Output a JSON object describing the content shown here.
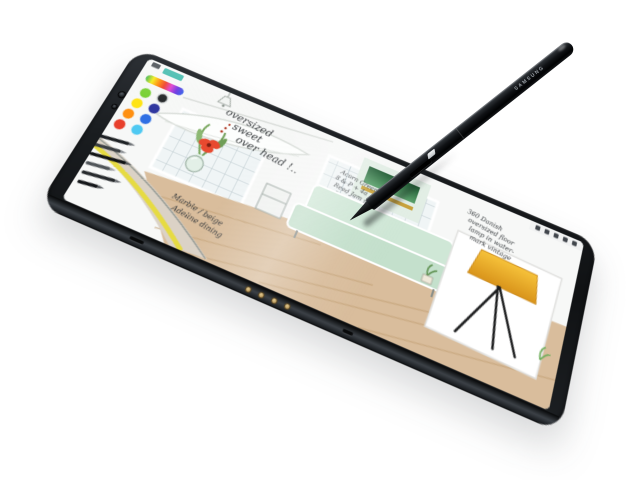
{
  "scene": {
    "description": "Product photo: Samsung tablet lying at an angle with S Pen stylus tip resting on screen; screen shows a sketching app with an interior-design drawing",
    "background_color": "#ffffff"
  },
  "tablet": {
    "body_color": "#17191c",
    "pogo_pin_count": 4,
    "camera_dot_count": 2
  },
  "stylus": {
    "label": "SAMSUNG",
    "body_color": "#101214"
  },
  "screen": {
    "mini_toolbar_icon_count": 5,
    "palette": {
      "preset_swatch": "#3cb9ab",
      "spectrum": [
        "#35b44a",
        "#f7ec13",
        "#ff8a00",
        "#ef3b25",
        "#e03bd0",
        "#6a30e0",
        "#2b59e8"
      ],
      "swatches": [
        {
          "name": "green",
          "hex": "#76d02f"
        },
        {
          "name": "black",
          "hex": "#202325"
        },
        {
          "name": "yellow",
          "hex": "#ffe414"
        },
        {
          "name": "navy",
          "hex": "#30379f"
        },
        {
          "name": "orange",
          "hex": "#ff9012"
        },
        {
          "name": "blue",
          "hex": "#2f6fe4"
        },
        {
          "name": "red",
          "hex": "#e8402c"
        },
        {
          "name": "cyan",
          "hex": "#4fc9f2"
        }
      ]
    },
    "annotations": {
      "overhead_1": "oversized",
      "overhead_2": "sweet",
      "overhead_3": "over head !..",
      "materials_1": "Acorn Green",
      "materials_2": "8 & P + 4a",
      "materials_3": "Reed Jam sofa",
      "materials_4": "Rural Jam look",
      "dining_1": "Marble / beige",
      "dining_2": "Adeline dining",
      "lamp_1": "360 Danish",
      "lamp_2": "oversized floor",
      "lamp_3": "lamp in water-",
      "lamp_4": "mark vintage"
    },
    "sketch_colors": {
      "sofa": "#cfe7d6",
      "sofa_seat": "#c4e0cc",
      "lamp_shade": "#efaf25",
      "floor": "#d9bd9c",
      "swatch_green": "#2e6b3c",
      "swatch_gold": "#c8a23b",
      "flower": "#e8492f",
      "table_stripe": "#e6db42",
      "vase": "#e3f0e7"
    }
  }
}
